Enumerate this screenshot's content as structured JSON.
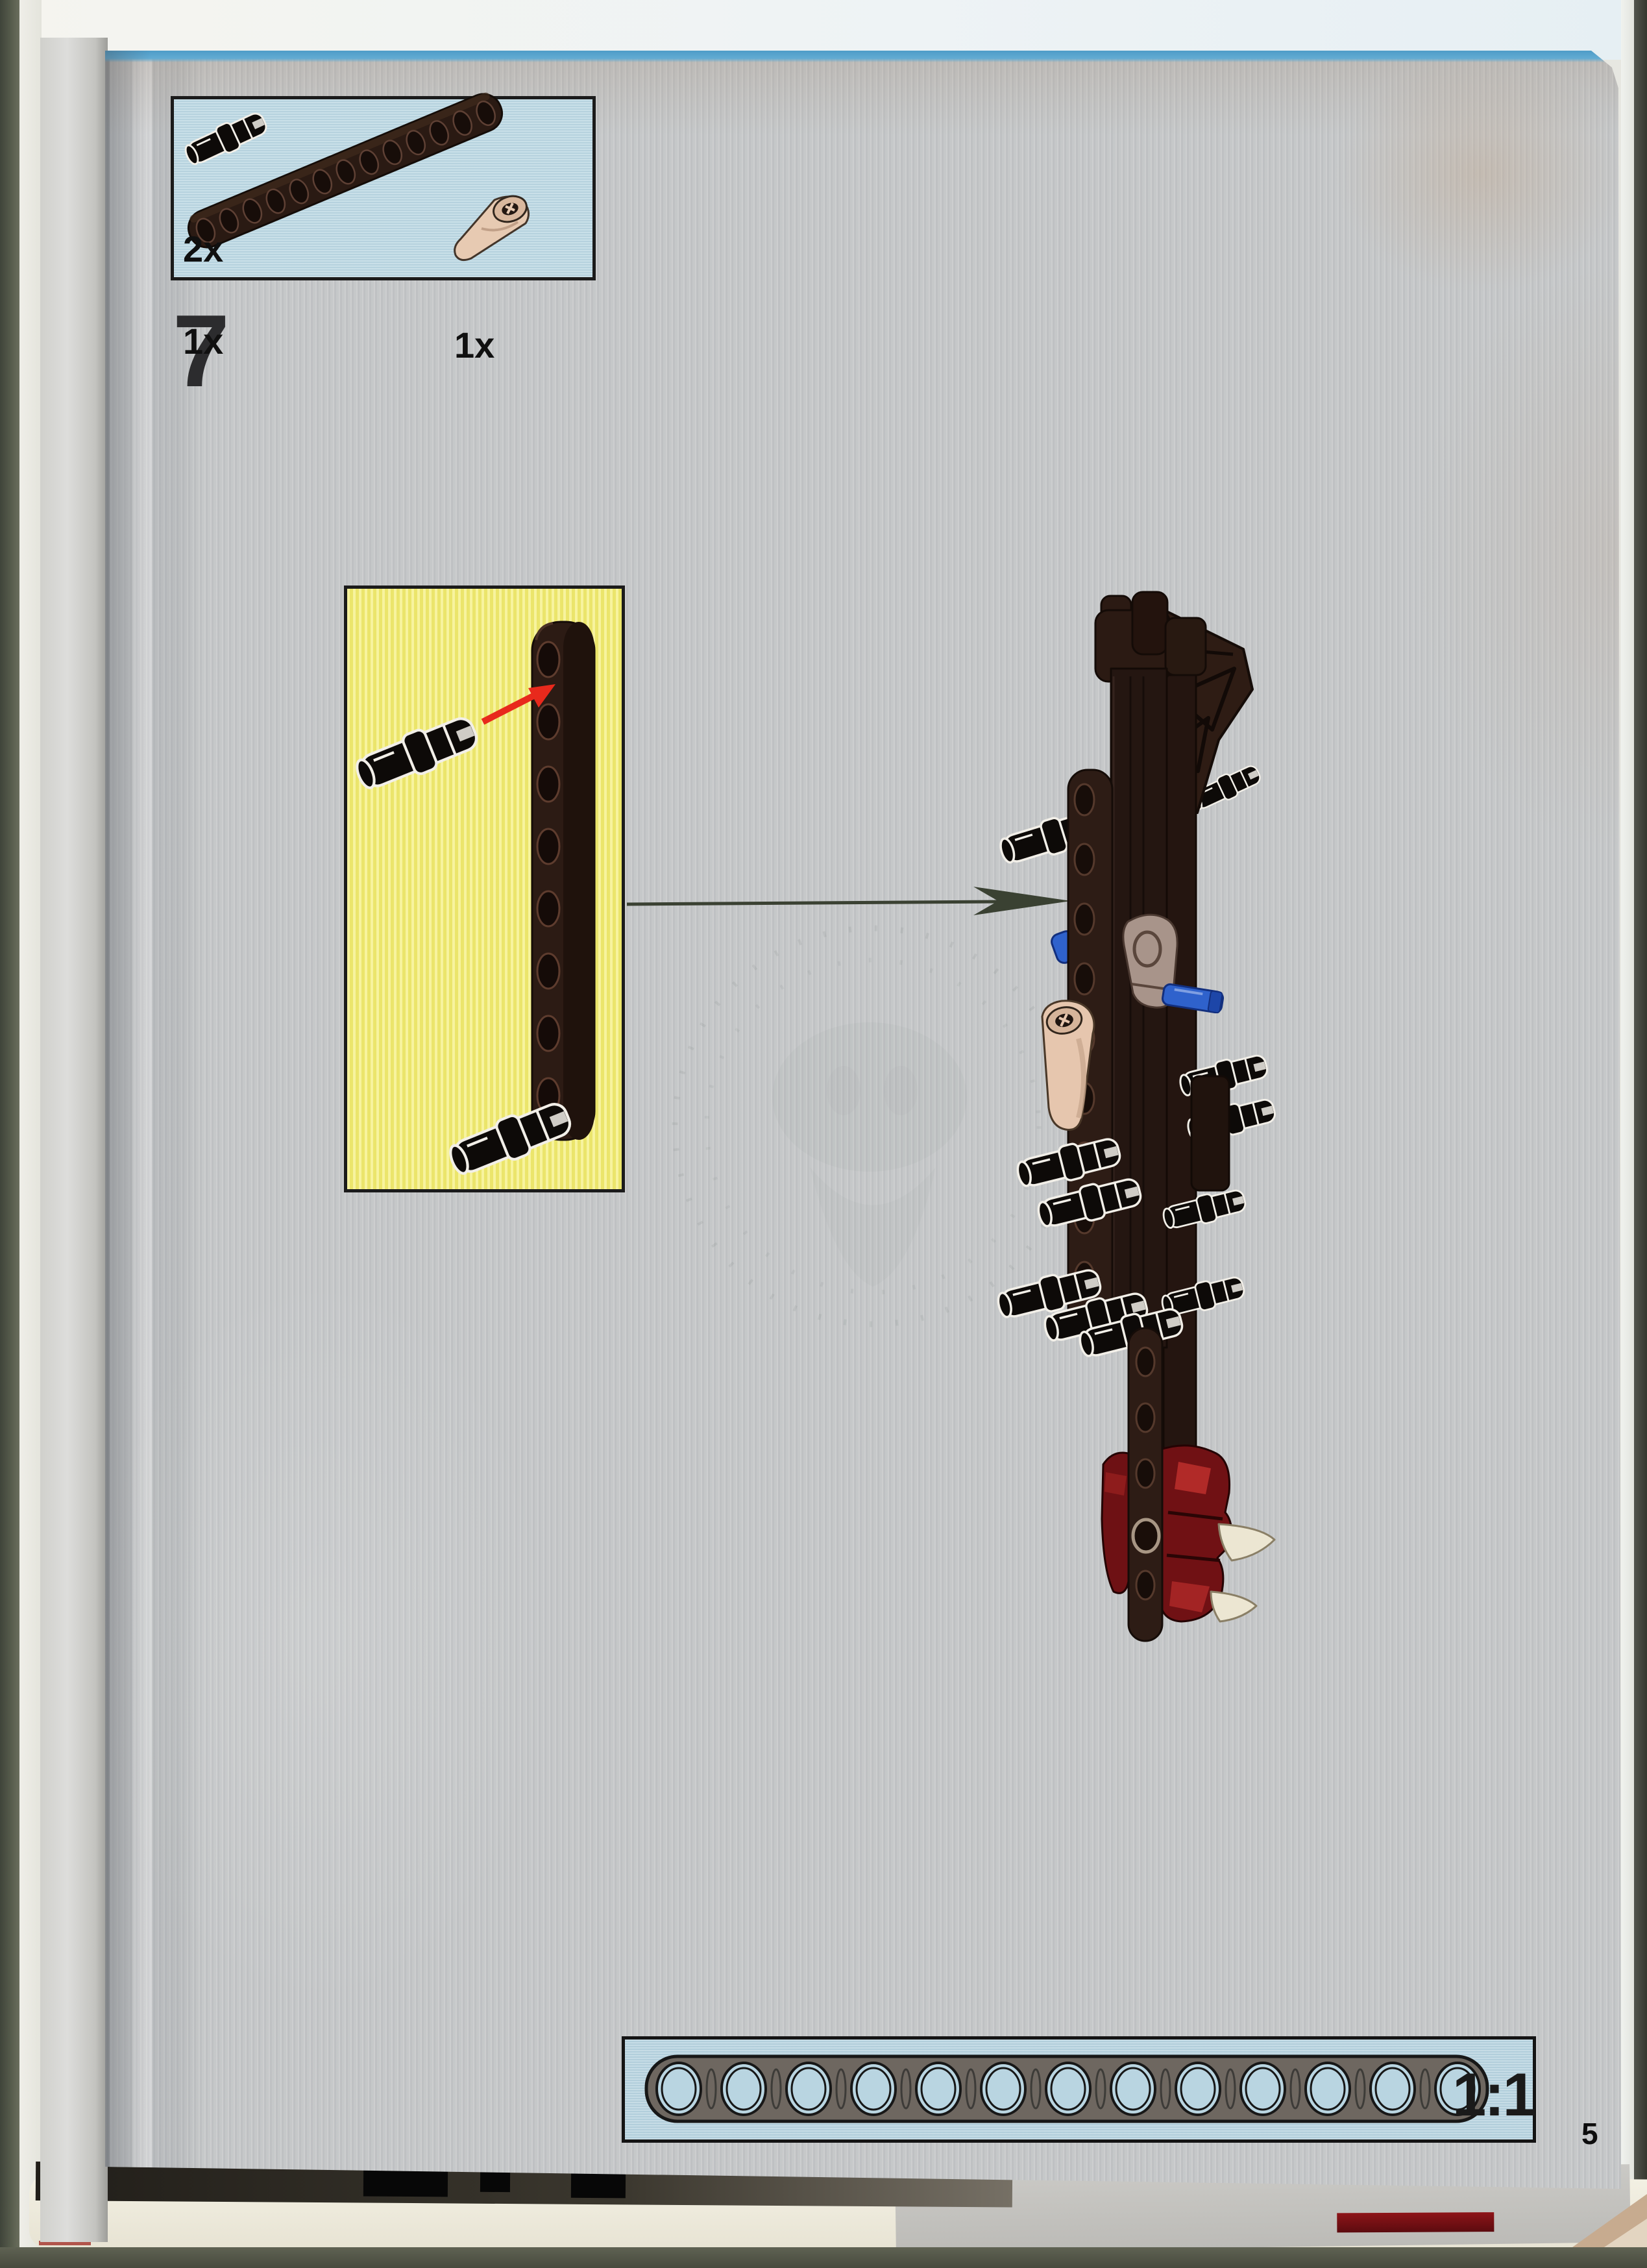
{
  "page": {
    "step_number": "7",
    "page_number": "5"
  },
  "parts_box": {
    "items": [
      {
        "icon": "technic-pin-icon",
        "count_label": "2x"
      },
      {
        "icon": "technic-beam-13-icon",
        "count_label": "1x"
      },
      {
        "icon": "horn-cone-icon",
        "count_label": "1x"
      }
    ]
  },
  "callout": {
    "arrow_color": "#e8291c"
  },
  "scale_box": {
    "label": "1:1",
    "beam_holes": 13
  },
  "colors": {
    "page_gray": "#c7c9ca",
    "box_blue": "#bcd8e3",
    "callout_yellow": "#f4ef79",
    "beam_dark": "#2b1b14",
    "pin_black": "#0d0a08",
    "axle_blue": "#2f62cc",
    "cone_tan": "#e7cab2",
    "foot_red": "#701114",
    "claw_cream": "#ece6d2",
    "top_edge_blue": "#4e9cc8"
  }
}
